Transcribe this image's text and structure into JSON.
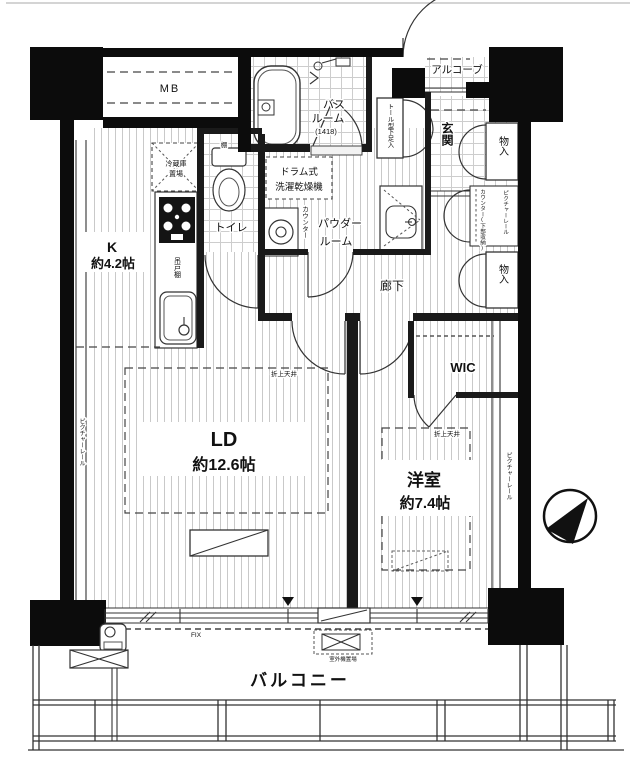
{
  "rooms": {
    "mb": {
      "label": "MB"
    },
    "bath": {
      "name_line1": "バス",
      "name_line2": "ルーム",
      "size": "(1418)"
    },
    "alcove": {
      "label": "アルコーブ"
    },
    "shoe_cabinet": {
      "label": "トール型下足入"
    },
    "entrance": {
      "label": "玄関"
    },
    "storage_top": {
      "label": "物入"
    },
    "storage_bottom": {
      "label": "物入"
    },
    "counter_storage": {
      "label": "カウンター(下部収納)"
    },
    "toilet": {
      "label": "トイレ",
      "shelf": "棚"
    },
    "laundry": {
      "machine_line1": "ドラム式",
      "machine_line2": "洗濯乾燥機",
      "counter": "カウンター"
    },
    "powder": {
      "name_line1": "パウダー",
      "name_line2": "ルーム"
    },
    "corridor": {
      "label": "廊下"
    },
    "kitchen": {
      "name": "K",
      "area": "約4.2帖",
      "fridge_line1": "冷蔵庫",
      "fridge_line2": "置場",
      "cupboard": "吊戸棚"
    },
    "living": {
      "name": "LD",
      "area": "約12.6帖",
      "ceiling": "折上天井"
    },
    "wic": {
      "label": "WIC"
    },
    "bedroom": {
      "name": "洋室",
      "area": "約7.4帖",
      "ceiling": "折上天井"
    },
    "balcony": {
      "label": "バルコニー",
      "window": "FIX",
      "outdoor_unit": "室外機置場"
    }
  },
  "annotations": {
    "picture_rail_left": "ピクチャーレール",
    "picture_rail_right": "ピクチャーレール",
    "picture_rail_top": "ピクチャーレール"
  }
}
